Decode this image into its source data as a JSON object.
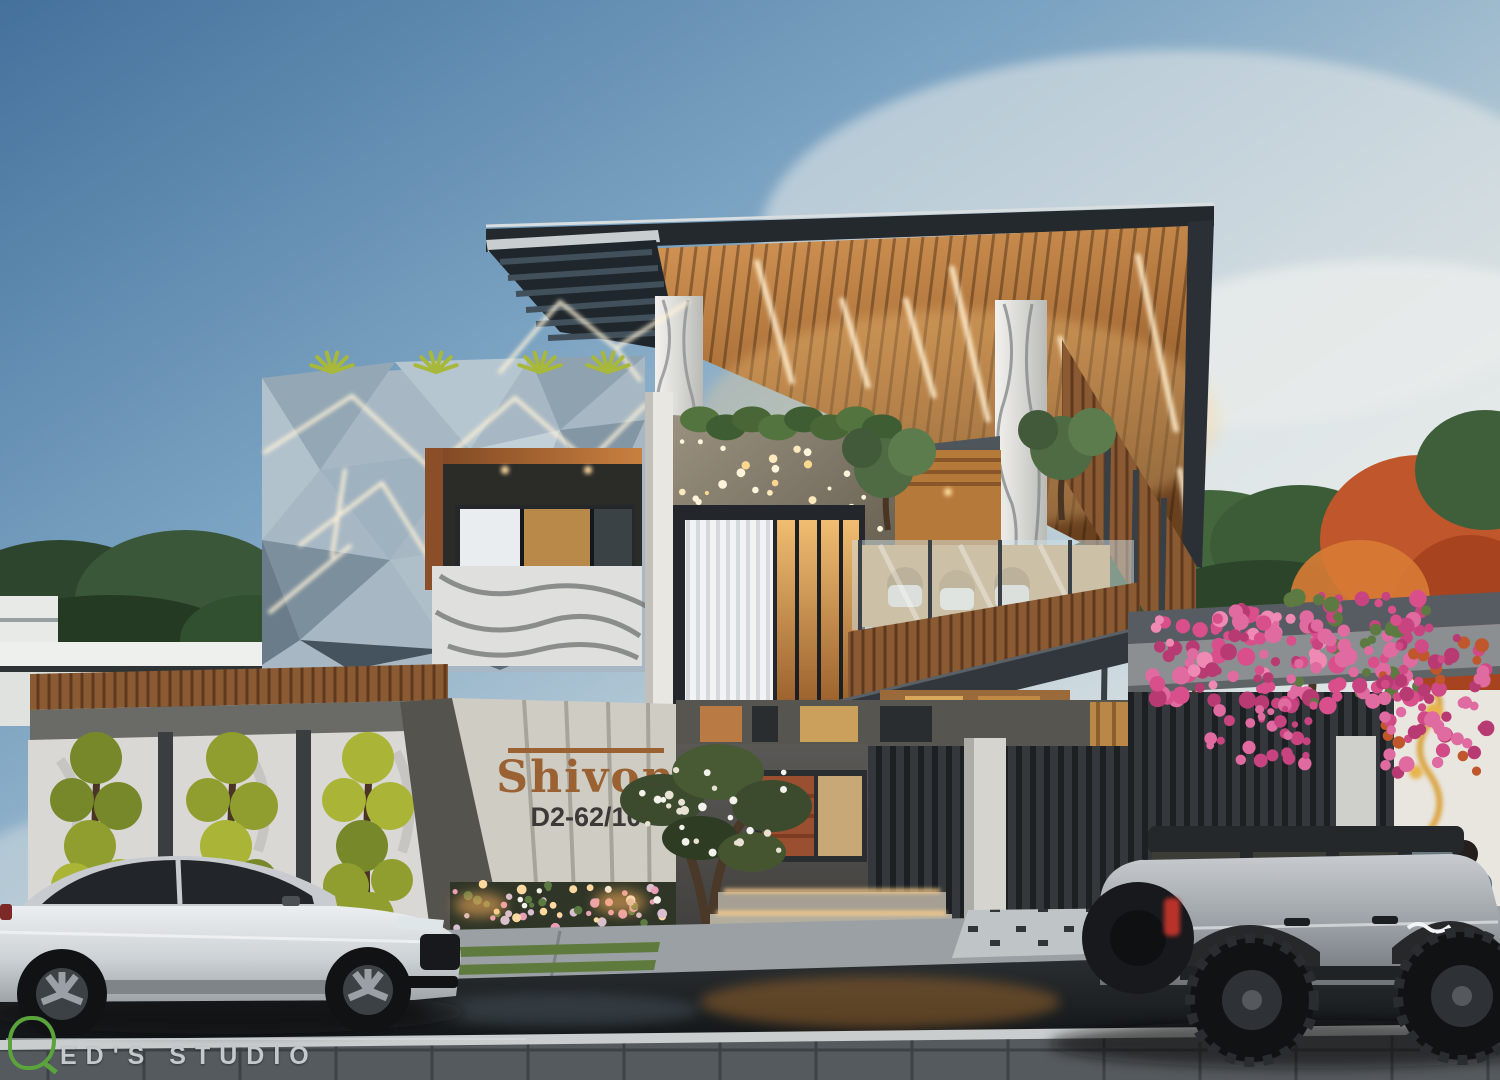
{
  "signage": {
    "house_name": "Shivon",
    "house_number": "D2-62/10"
  },
  "watermark": {
    "logo_letter": "Q",
    "studio_text": "ED'S STUDIO"
  },
  "palette": {
    "sky_top": "#47749e",
    "sky_horizon": "#e6e9e6",
    "roof_dark": "#24292e",
    "ceiling_wood": "#a9713c",
    "facade_panel": "#a7b8c4",
    "led_warm": "#ffeccb",
    "marble_light": "#e3e2de",
    "concrete": "#8b8f91",
    "granite_dark": "#4e4c49",
    "gate_slat": "#2c3034",
    "wood_fascia": "#8a5a33",
    "topiary_green": "#9aa834",
    "bougainvillea_pink": "#d84f8c",
    "autumn_tree": "#c05a2a",
    "road_asphalt": "#1c2024",
    "sedan_white": "#d7dade",
    "suv_silver": "#9fa4a8",
    "sign_brass": "#9a6232",
    "watermark_green": "#5ba33c"
  }
}
